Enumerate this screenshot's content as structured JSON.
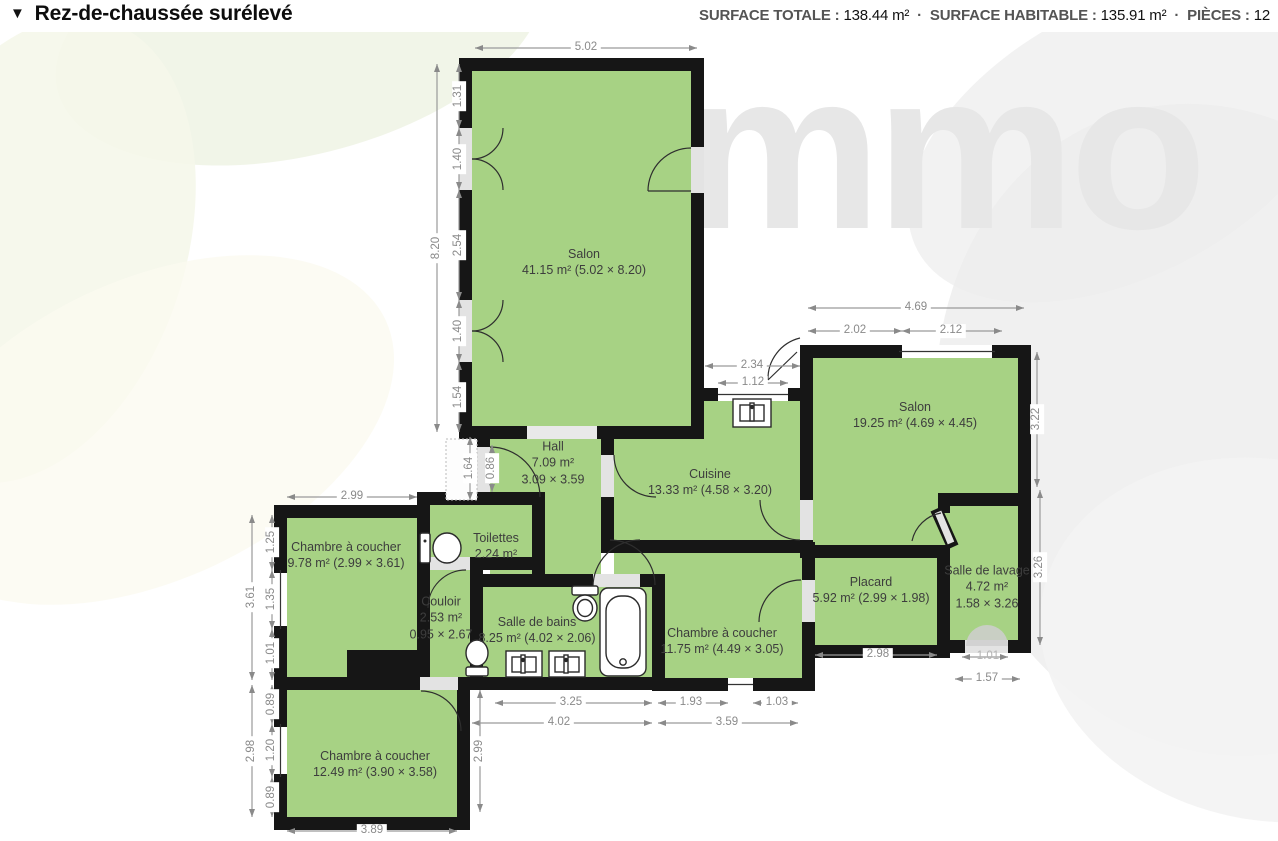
{
  "header": {
    "collapse_icon": "▼",
    "title": "Rez-de-chaussée surélevé",
    "sep": "·",
    "stats": [
      {
        "label": "SURFACE TOTALE :",
        "value": "138.44 m²"
      },
      {
        "label": "SURFACE HABITABLE :",
        "value": "135.91 m²"
      },
      {
        "label": "PIÈCES :",
        "value": "12"
      }
    ]
  },
  "watermark": "immo",
  "rooms": [
    {
      "name": "Salon",
      "line2": "41.15 m² (5.02 × 8.20)"
    },
    {
      "name": "Salon",
      "line2": "19.25 m² (4.69 × 4.45)"
    },
    {
      "name": "Hall",
      "line2": "7.09 m²",
      "line3": "3.09 × 3.59"
    },
    {
      "name": "Cuisine",
      "line2": "13.33 m² (4.58 × 3.20)"
    },
    {
      "name": "Toilettes",
      "line2": "2.24 m²"
    },
    {
      "name": "Chambre à coucher",
      "line2": "9.78 m² (2.99 × 3.61)"
    },
    {
      "name": "Couloir",
      "line2": "2.53 m²",
      "line3": "0.95 × 2.67"
    },
    {
      "name": "Salle de bains",
      "line2": "8.25 m² (4.02 × 2.06)"
    },
    {
      "name": "Chambre à coucher",
      "line2": "11.75 m² (4.49 × 3.05)"
    },
    {
      "name": "Placard",
      "line2": "5.92 m² (2.99 × 1.98)"
    },
    {
      "name": "Salle de lavage",
      "line2": "4.72 m²",
      "line3": "1.58 × 3.26"
    },
    {
      "name": "Chambre à coucher",
      "line2": "12.49 m² (3.90 × 3.58)"
    }
  ],
  "dimensions": {
    "salon_width": "5.02",
    "salon_height": "8.20",
    "salon_seg_top": "1.31",
    "salon_door1": "1.40",
    "salon_seg_mid": "2.54",
    "salon_door2": "1.40",
    "salon_seg_bot": "1.54",
    "salon2_width": "4.69",
    "salon2_seg1": "2.02",
    "salon2_window": "2.12",
    "salon2_height": "3.22",
    "cuisine_opening": "2.34",
    "cuisine_window": "1.12",
    "entry_depth": "1.64",
    "entry_width": "0.86",
    "ch9_width": "2.99",
    "ch9_height": "3.61",
    "ch9_seg1": "1.25",
    "ch9_window": "1.35",
    "ch9_seg3": "1.01",
    "ch12_height": "2.98",
    "ch12_seg1": "0.89",
    "ch12_window": "1.20",
    "ch12_seg3": "0.89",
    "ch12_width": "3.89",
    "ch12_right": "2.99",
    "sdb_bottom": "3.25",
    "sdb_total": "4.02",
    "ch11_seg1": "1.93",
    "ch11_seg2": "1.03",
    "ch11_total": "3.59",
    "placard_bottom": "2.98",
    "lavage_door": "1.01",
    "lavage_bottom": "1.57",
    "lavage_height": "3.26"
  }
}
